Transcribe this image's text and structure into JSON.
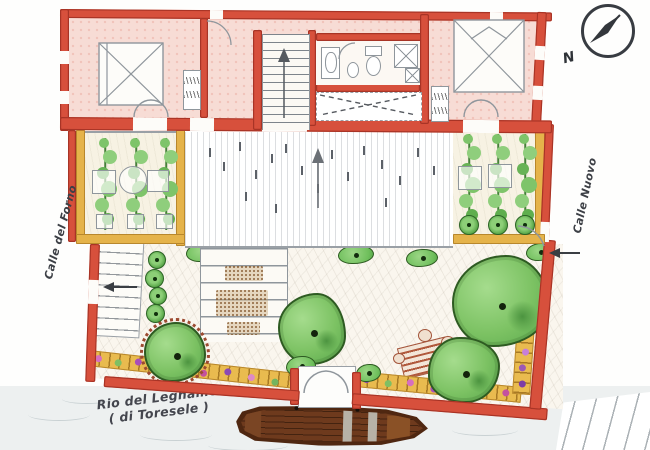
{
  "labels": {
    "street_left": "Calle del Forno",
    "street_right": "Calle Nuovo",
    "canal_name": "Rio del Legname",
    "canal_name_alt": "( di Toresele )",
    "compass_north": "N"
  },
  "colors": {
    "wall_red": "#d7503c",
    "planting_tan": "#e5b34a",
    "foliage_green": "#7cc263",
    "boat_brown": "#5d2f15",
    "water_grey": "#edf0f0",
    "line_grey": "#8f969c",
    "room_pink": "#f7dcd5"
  }
}
